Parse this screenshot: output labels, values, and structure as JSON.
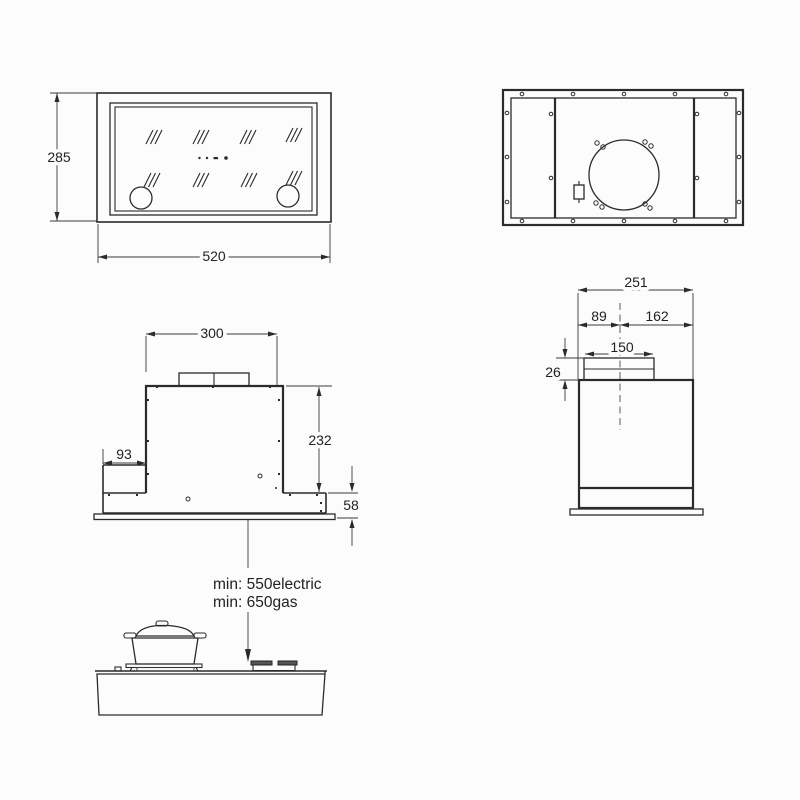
{
  "colors": {
    "line": "#2b2b2b",
    "background": "#fcfcfc",
    "centerline": "#6a6a6a",
    "burner_fill": "#555555"
  },
  "front_panel_view": {
    "height_dim": "285",
    "width_dim": "520"
  },
  "front_elevation_view": {
    "body_width_dim": "300",
    "step_dim": "93",
    "body_height_dim": "232",
    "plenum_height_dim": "58"
  },
  "side_view": {
    "depth_dim": "251",
    "duct_offset_front_dim": "89",
    "duct_offset_rear_dim": "162",
    "duct_width_dim": "150",
    "collar_height_dim": "26"
  },
  "clearance": {
    "electric_label": "min: 550electric",
    "gas_label": "min: 650gas"
  }
}
